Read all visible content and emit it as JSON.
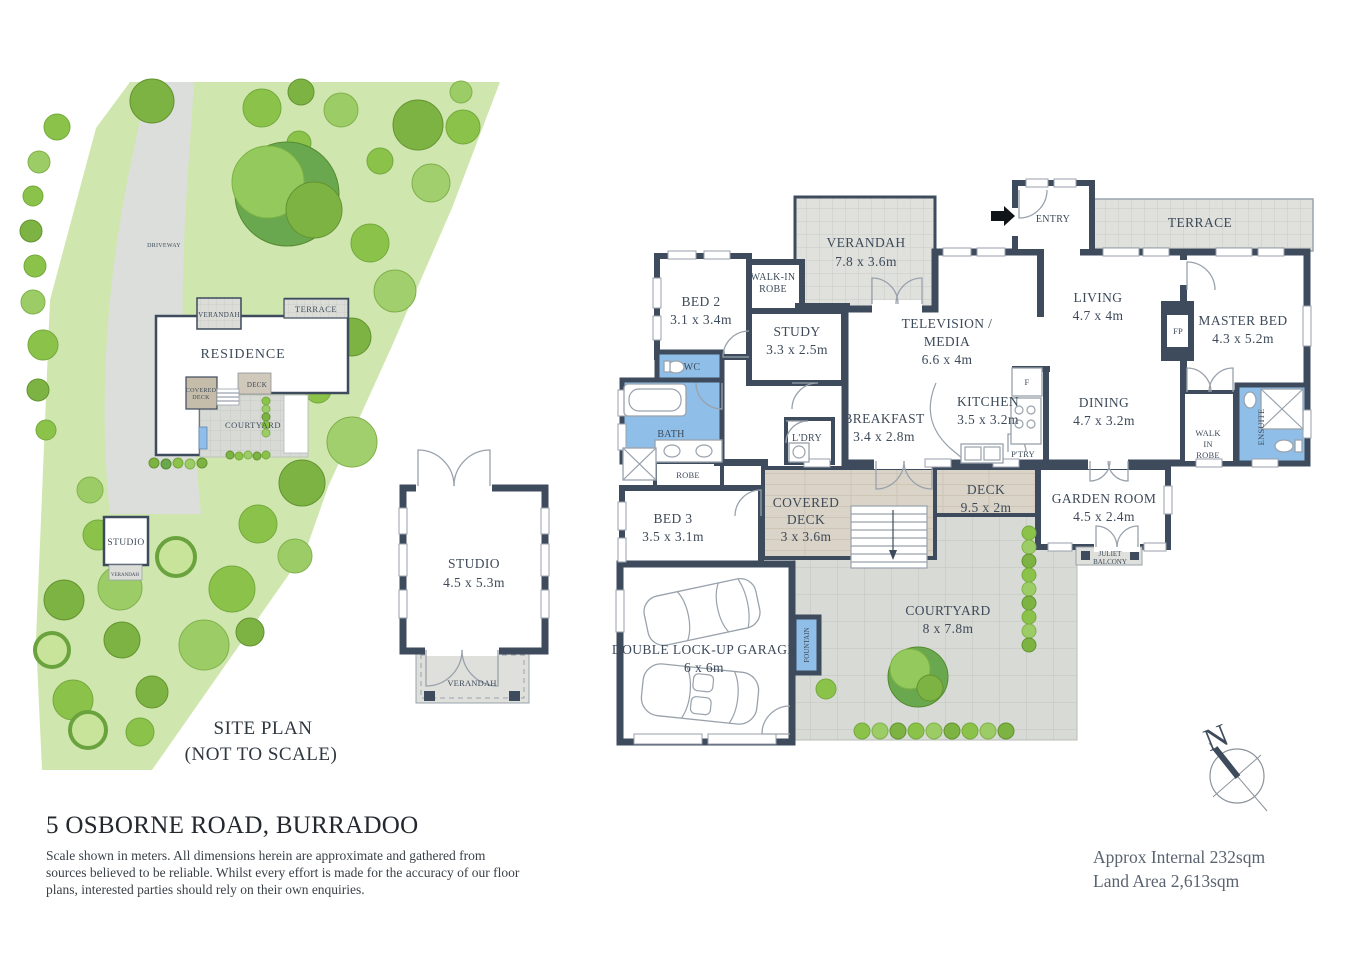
{
  "colors": {
    "wall": "#3d4b5c",
    "wet_area": "#8fbfe8",
    "wood_deck": "#dad3c7",
    "paving": "#d8dad6",
    "hatch_paving": "#e0e1dd",
    "grass": "#cfe7af",
    "text": "#3d4a59"
  },
  "site_plan": {
    "labels": {
      "driveway": "DRIVEWAY",
      "verandah": "VERANDAH",
      "terrace": "TERRACE",
      "residence": "RESIDENCE",
      "covered_deck_l1": "COVERED",
      "covered_deck_l2": "DECK",
      "deck": "DECK",
      "courtyard": "COURTYARD",
      "studio": "STUDIO",
      "studio_verandah": "VERANDAH"
    },
    "caption_l1": "SITE PLAN",
    "caption_l2": "(NOT TO SCALE)"
  },
  "studio_plan": {
    "name": "STUDIO",
    "dims": "4.5 x 5.3m",
    "verandah": "VERANDAH"
  },
  "floor_plan": {
    "verandah": {
      "name": "VERANDAH",
      "dims": "7.8 x 3.6m"
    },
    "entry": {
      "name": "ENTRY"
    },
    "terrace": {
      "name": "TERRACE"
    },
    "bed2": {
      "name": "BED 2",
      "dims": "3.1 x 3.4m"
    },
    "walkin_robe": {
      "l1": "WALK-IN",
      "l2": "ROBE"
    },
    "study": {
      "name": "STUDY",
      "dims": "3.3 x 2.5m"
    },
    "tv_media": {
      "l1": "TELEVISION /",
      "l2": "MEDIA",
      "dims": "6.6 x 4m"
    },
    "living": {
      "name": "LIVING",
      "dims": "4.7 x 4m"
    },
    "master_bed": {
      "name": "MASTER BED",
      "dims": "4.3 x 5.2m"
    },
    "fp": {
      "name": "FP"
    },
    "wc": {
      "name": "WC"
    },
    "bath": {
      "name": "BATH"
    },
    "robe": {
      "name": "ROBE"
    },
    "kitchen": {
      "name": "KITCHEN",
      "dims": "3.5 x 3.2m"
    },
    "fridge": {
      "name": "F"
    },
    "pantry": {
      "name": "P'TRY"
    },
    "dining": {
      "name": "DINING",
      "dims": "4.7 x 3.2m"
    },
    "breakfast": {
      "name": "BREAKFAST",
      "dims": "3.4 x 2.8m"
    },
    "laundry": {
      "name": "L'DRY"
    },
    "master_wir": {
      "l1": "WALK",
      "l2": "IN",
      "l3": "ROBE"
    },
    "ensuite": {
      "name": "ENSUITE"
    },
    "bed3": {
      "name": "BED 3",
      "dims": "3.5 x 3.1m"
    },
    "covered_deck": {
      "l1": "COVERED",
      "l2": "DECK",
      "dims": "3 x 3.6m"
    },
    "deck": {
      "name": "DECK",
      "dims": "9.5 x 2m"
    },
    "garden_room": {
      "name": "GARDEN ROOM",
      "dims": "4.5 x 2.4m"
    },
    "juliet": {
      "l1": "JULIET",
      "l2": "BALCONY"
    },
    "courtyard": {
      "name": "COURTYARD",
      "dims": "8 x 7.8m"
    },
    "fountain": {
      "name": "FOUNTAIN"
    },
    "garage": {
      "name": "DOUBLE LOCK-UP GARAGE",
      "dims": "6 x 6m"
    }
  },
  "footer": {
    "address": "5 OSBORNE ROAD, BURRADOO",
    "disclaimer_l1": "Scale shown in meters. All dimensions herein are approximate and gathered from",
    "disclaimer_l2": "sources believed to be reliable. Whilst every effort is made for the accuracy of our floor",
    "disclaimer_l3": "plans, interested parties should rely on their own enquiries.",
    "approx_internal": "Approx Internal 232sqm",
    "land_area": "Land Area 2,613sqm",
    "compass_north": "N"
  }
}
